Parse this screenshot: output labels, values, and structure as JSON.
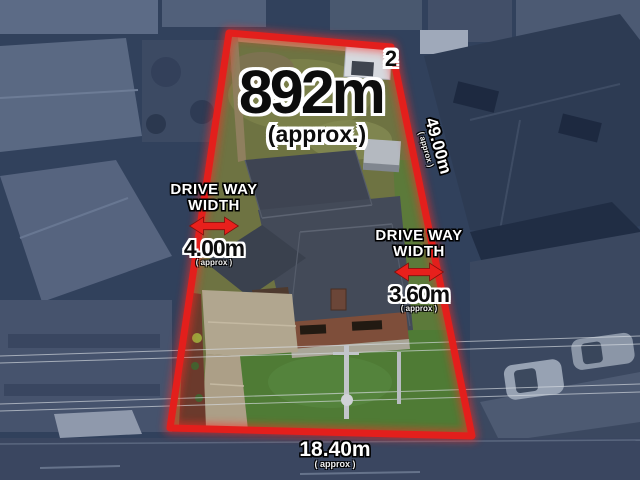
{
  "annotations": {
    "area": {
      "value": "892m",
      "sup": "2",
      "approx": "(approx.)"
    },
    "driveway_left": {
      "line1": "DRIVE WAY",
      "line2": "WIDTH",
      "value": "4.00m",
      "approx": "( approx )"
    },
    "driveway_right": {
      "line1": "DRIVE WAY",
      "line2": "WIDTH",
      "value": "3.60m",
      "approx": "( approx )"
    },
    "side_boundary": {
      "value": "49.00m",
      "approx": "( approx )"
    },
    "frontage": {
      "value": "18.40m",
      "approx": "( approx )"
    }
  },
  "colors": {
    "boundary": "#e31f1c",
    "arrow": "#e8201c",
    "background_tint": "#2e3f5a"
  }
}
